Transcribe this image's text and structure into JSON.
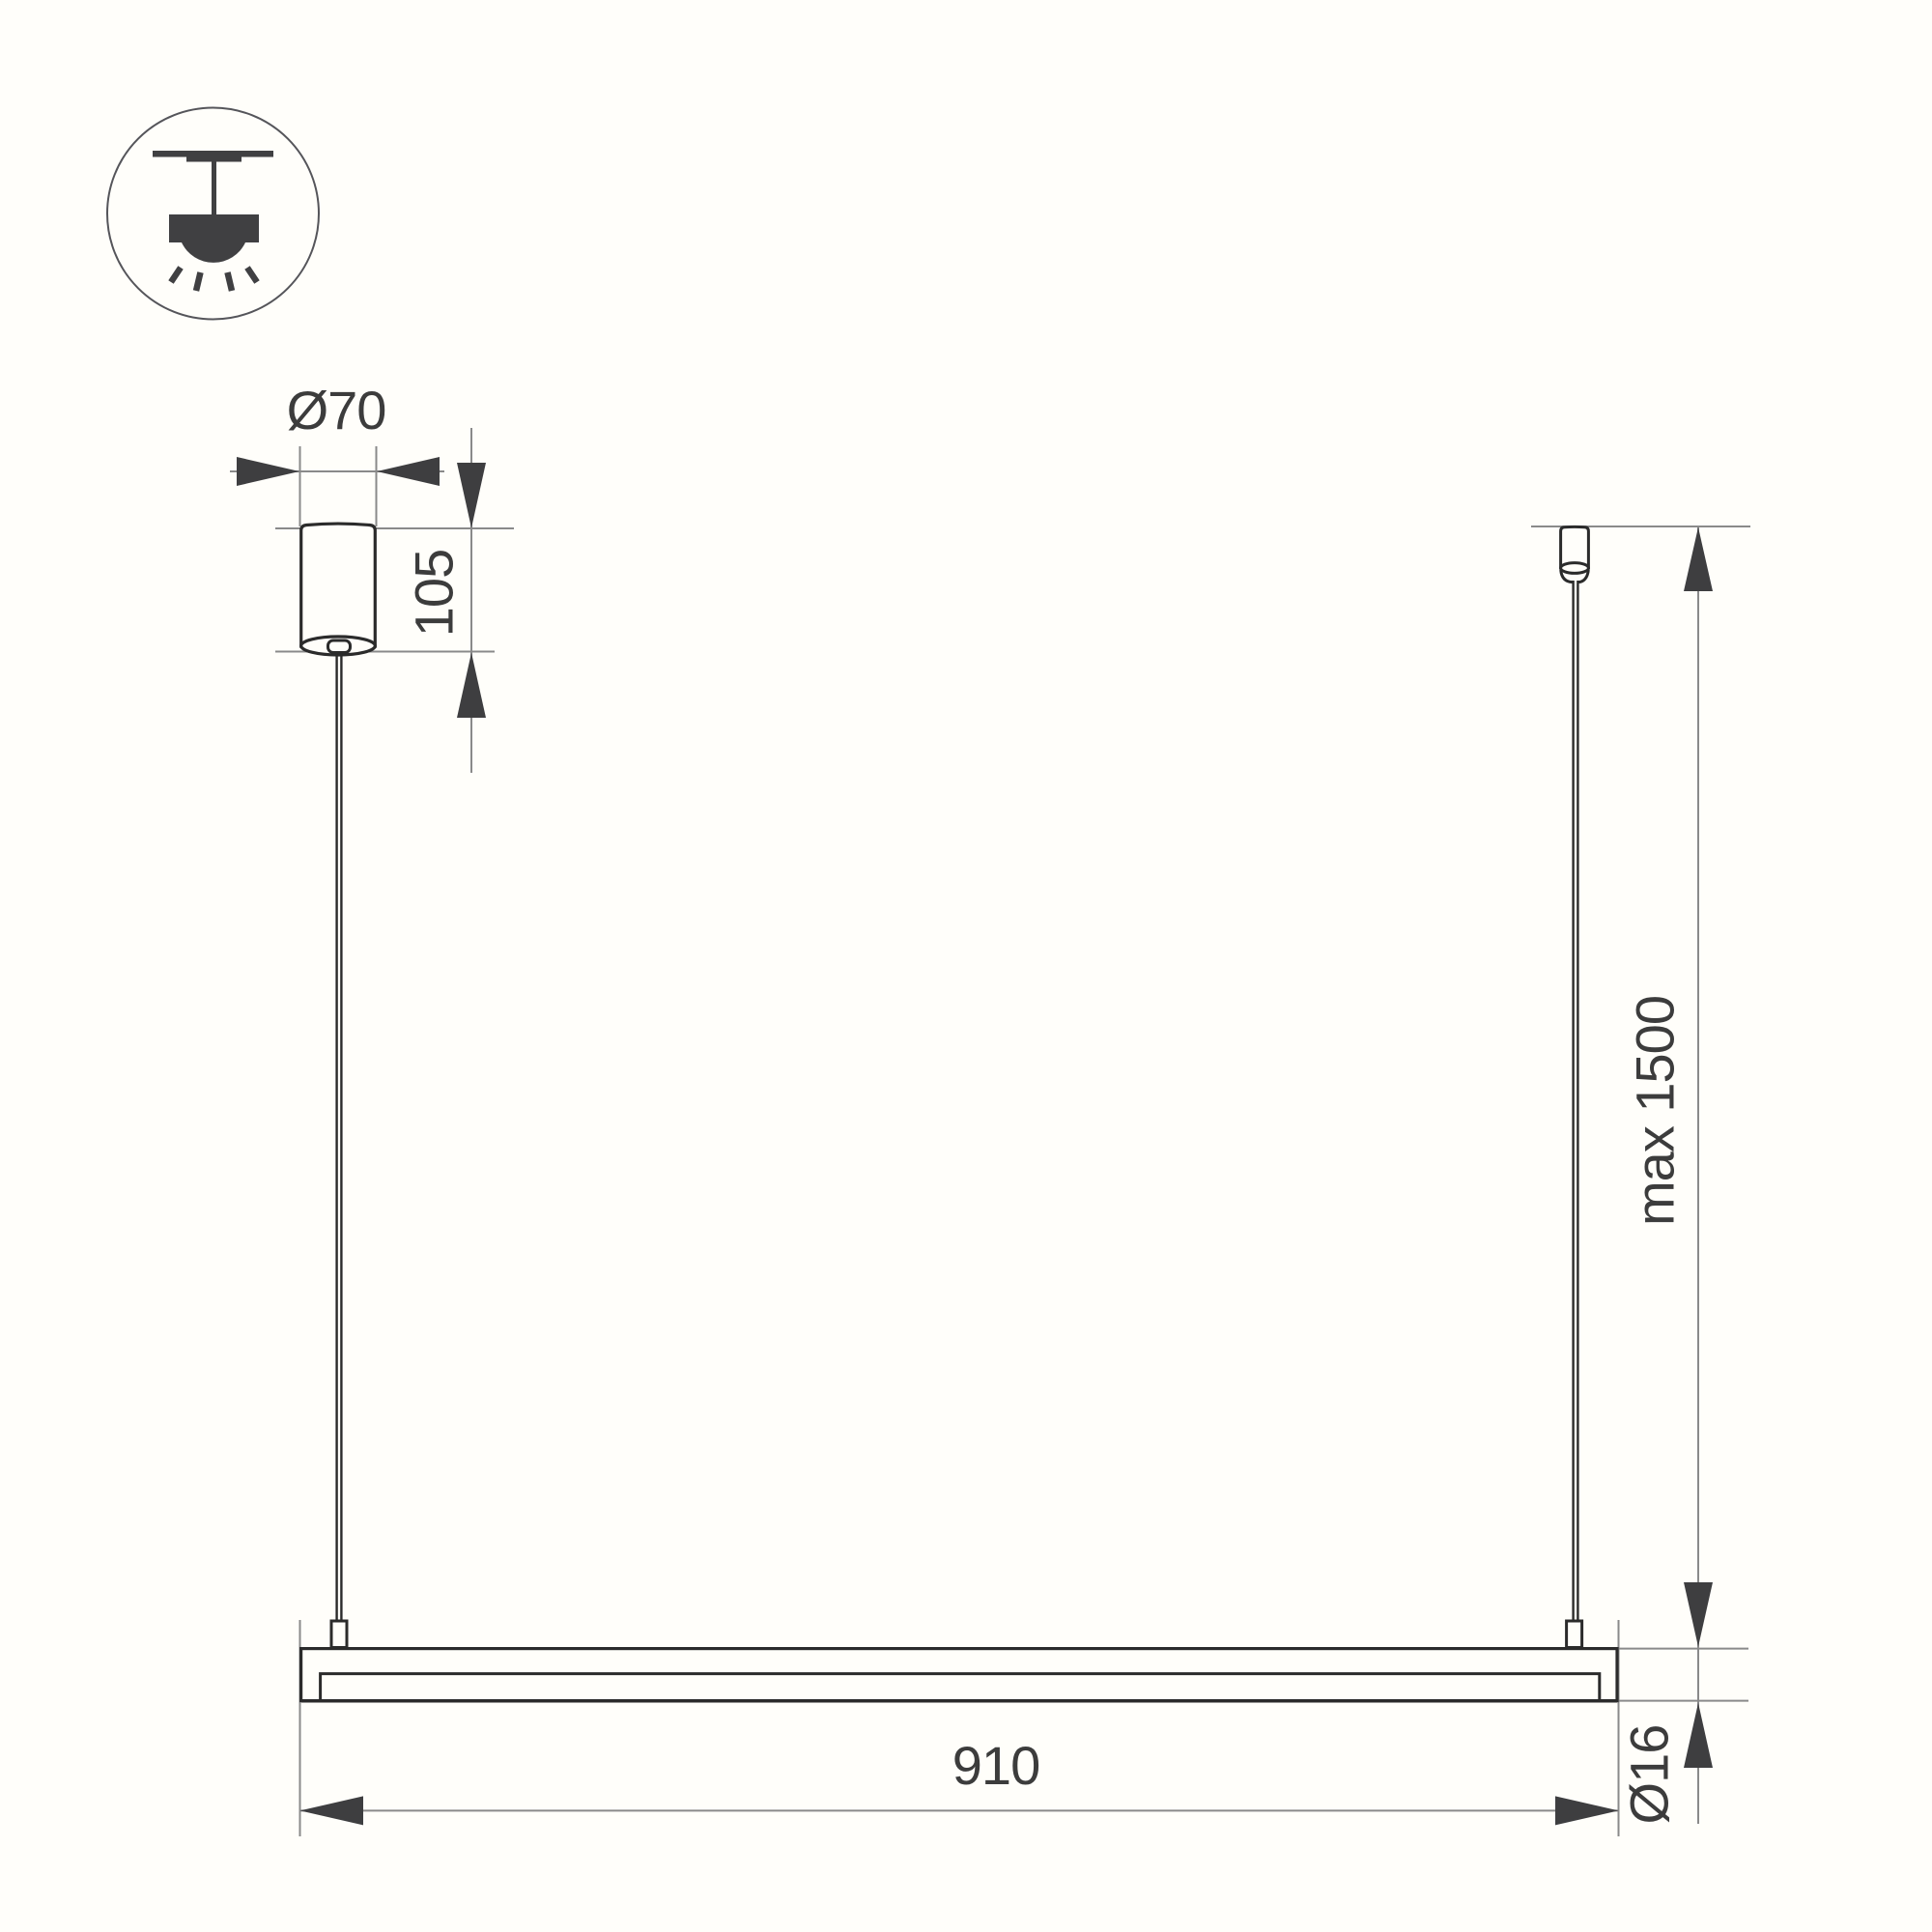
{
  "drawing": {
    "type": "pendant-linear-light-installation-drawing",
    "icons": {
      "legend": "ceiling-pendant-light-icon"
    },
    "labels": {
      "canopy_diameter": "Ø70",
      "canopy_height": "105",
      "max_suspension": "max 1500",
      "fixture_length": "910",
      "tube_diameter": "Ø16"
    },
    "colors": {
      "object_line": "#2b2b2b",
      "dimension_line": "#8a8a8a",
      "arrow_fill": "#3e3e40",
      "text": "#3c3c3c",
      "icon": "#404042",
      "background": "#fffefa"
    }
  }
}
